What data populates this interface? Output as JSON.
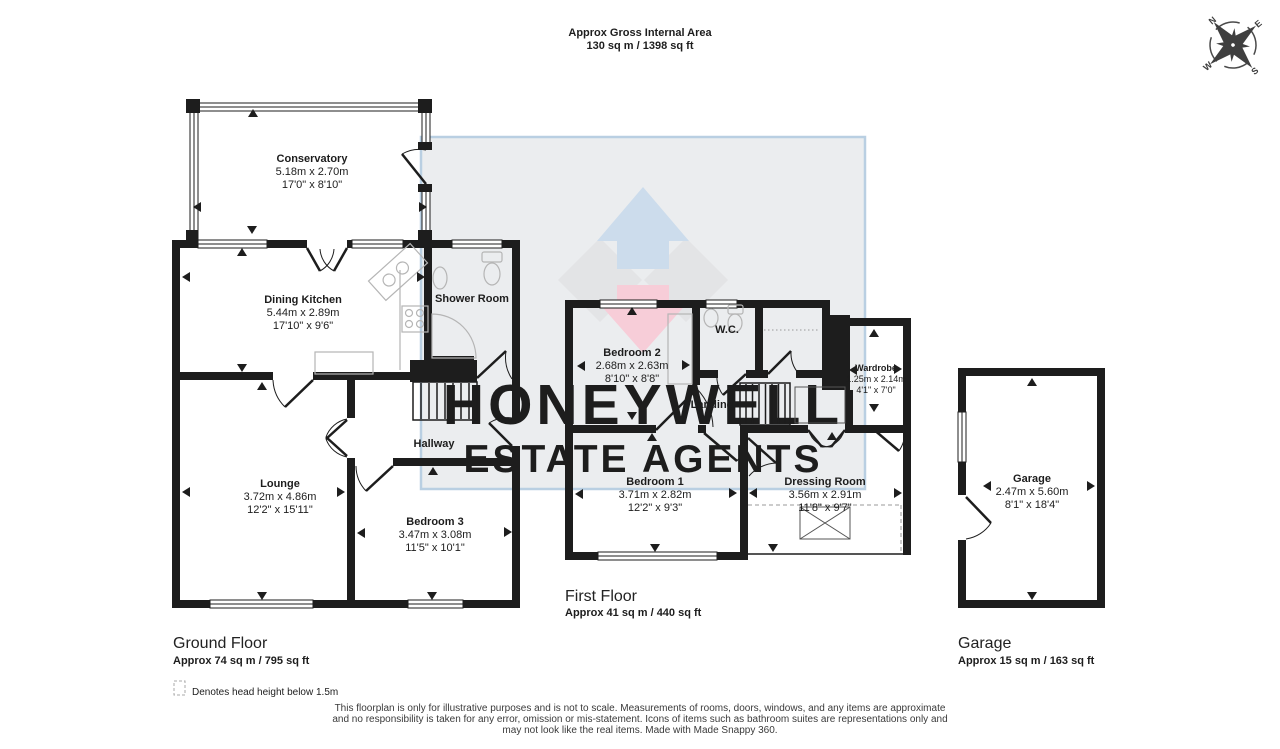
{
  "header": {
    "title": "Approx Gross Internal Area",
    "area": "130 sq m / 1398 sq ft"
  },
  "watermark": {
    "line1": "HONEYWELL",
    "line2": "ESTATE AGENTS"
  },
  "compass": {
    "n": "N",
    "e": "E",
    "s": "S",
    "w": "W"
  },
  "rooms": {
    "conservatory": {
      "name": "Conservatory",
      "metric": "5.18m x 2.70m",
      "imperial": "17'0\" x 8'10\""
    },
    "dining_kitchen": {
      "name": "Dining Kitchen",
      "metric": "5.44m x 2.89m",
      "imperial": "17'10\" x 9'6\""
    },
    "shower_room": {
      "name": "Shower Room"
    },
    "hallway": {
      "name": "Hallway"
    },
    "lounge": {
      "name": "Lounge",
      "metric": "3.72m x 4.86m",
      "imperial": "12'2\" x 15'11\""
    },
    "bedroom3": {
      "name": "Bedroom 3",
      "metric": "3.47m x 3.08m",
      "imperial": "11'5\" x 10'1\""
    },
    "bedroom2": {
      "name": "Bedroom 2",
      "metric": "2.68m x 2.63m",
      "imperial": "8'10\" x 8'8\""
    },
    "wc": {
      "name": "W.C."
    },
    "landing": {
      "name": "Landing"
    },
    "wardrobe": {
      "name": "Wardrobe",
      "metric": "1.25m x 2.14m",
      "imperial": "4'1\" x 7'0\""
    },
    "bedroom1": {
      "name": "Bedroom 1",
      "metric": "3.71m x 2.82m",
      "imperial": "12'2\" x 9'3\""
    },
    "dressing_room": {
      "name": "Dressing Room",
      "metric": "3.56m x 2.91m",
      "imperial": "11'8\" x 9'7\""
    },
    "garage": {
      "name": "Garage",
      "metric": "2.47m x 5.60m",
      "imperial": "8'1\" x 18'4\""
    }
  },
  "floors": {
    "ground": {
      "label": "Ground Floor",
      "area": "Approx 74 sq m / 795 sq ft"
    },
    "first": {
      "label": "First Floor",
      "area": "Approx 41 sq m / 440 sq ft"
    },
    "garage": {
      "label": "Garage",
      "area": "Approx 15 sq m / 163 sq ft"
    }
  },
  "legend": {
    "text": "Denotes head height below 1.5m"
  },
  "disclaimer": {
    "line1": "This floorplan is only for illustrative purposes and is not to scale. Measurements of rooms, doors, windows, and any items are approximate",
    "line2": "and no responsibility is taken for any error, omission or mis-statement. Icons of items such as bathroom suites are representations only and",
    "line3": "may not look like the real items. Made with Made Snappy 360."
  },
  "colors": {
    "wall": "#1d1d1d",
    "watermark_fill": "#ebedef",
    "watermark_border": "#b9cfe2",
    "watermark_text": "#c7d8e9",
    "logo_blue": "#ccdcec",
    "logo_grey": "#e3e4e6",
    "logo_pink": "#f7cdd8",
    "fixture": "#b5b5b5"
  }
}
